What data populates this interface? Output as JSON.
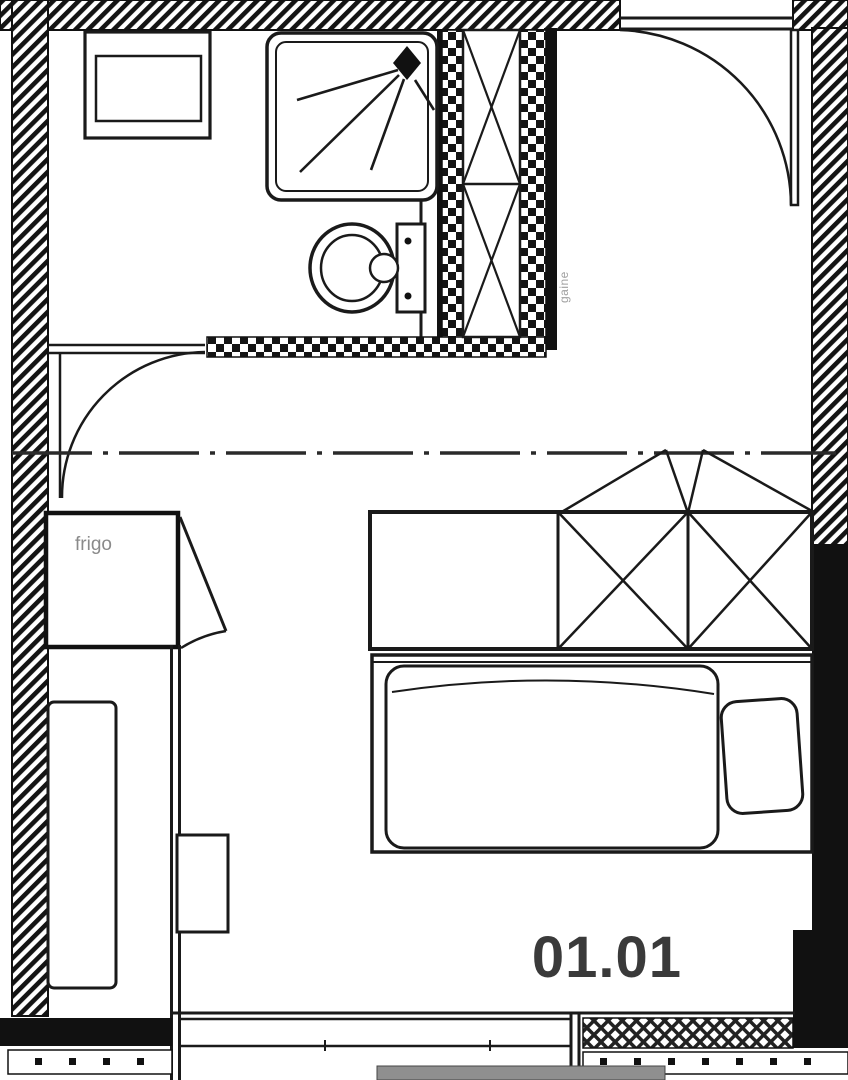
{
  "plan": {
    "room_number": "01.01",
    "labels": {
      "fridge": "frigo",
      "duct": "gaine"
    },
    "colors": {
      "ink": "#1a1a1a",
      "wall_fill": "#111111",
      "muted_label": "#8a8a8a",
      "duct_label": "#a0a0a0",
      "room_number": "#3a3a3a",
      "balcony_bar": "#8f8f8f",
      "background": "#ffffff"
    }
  }
}
